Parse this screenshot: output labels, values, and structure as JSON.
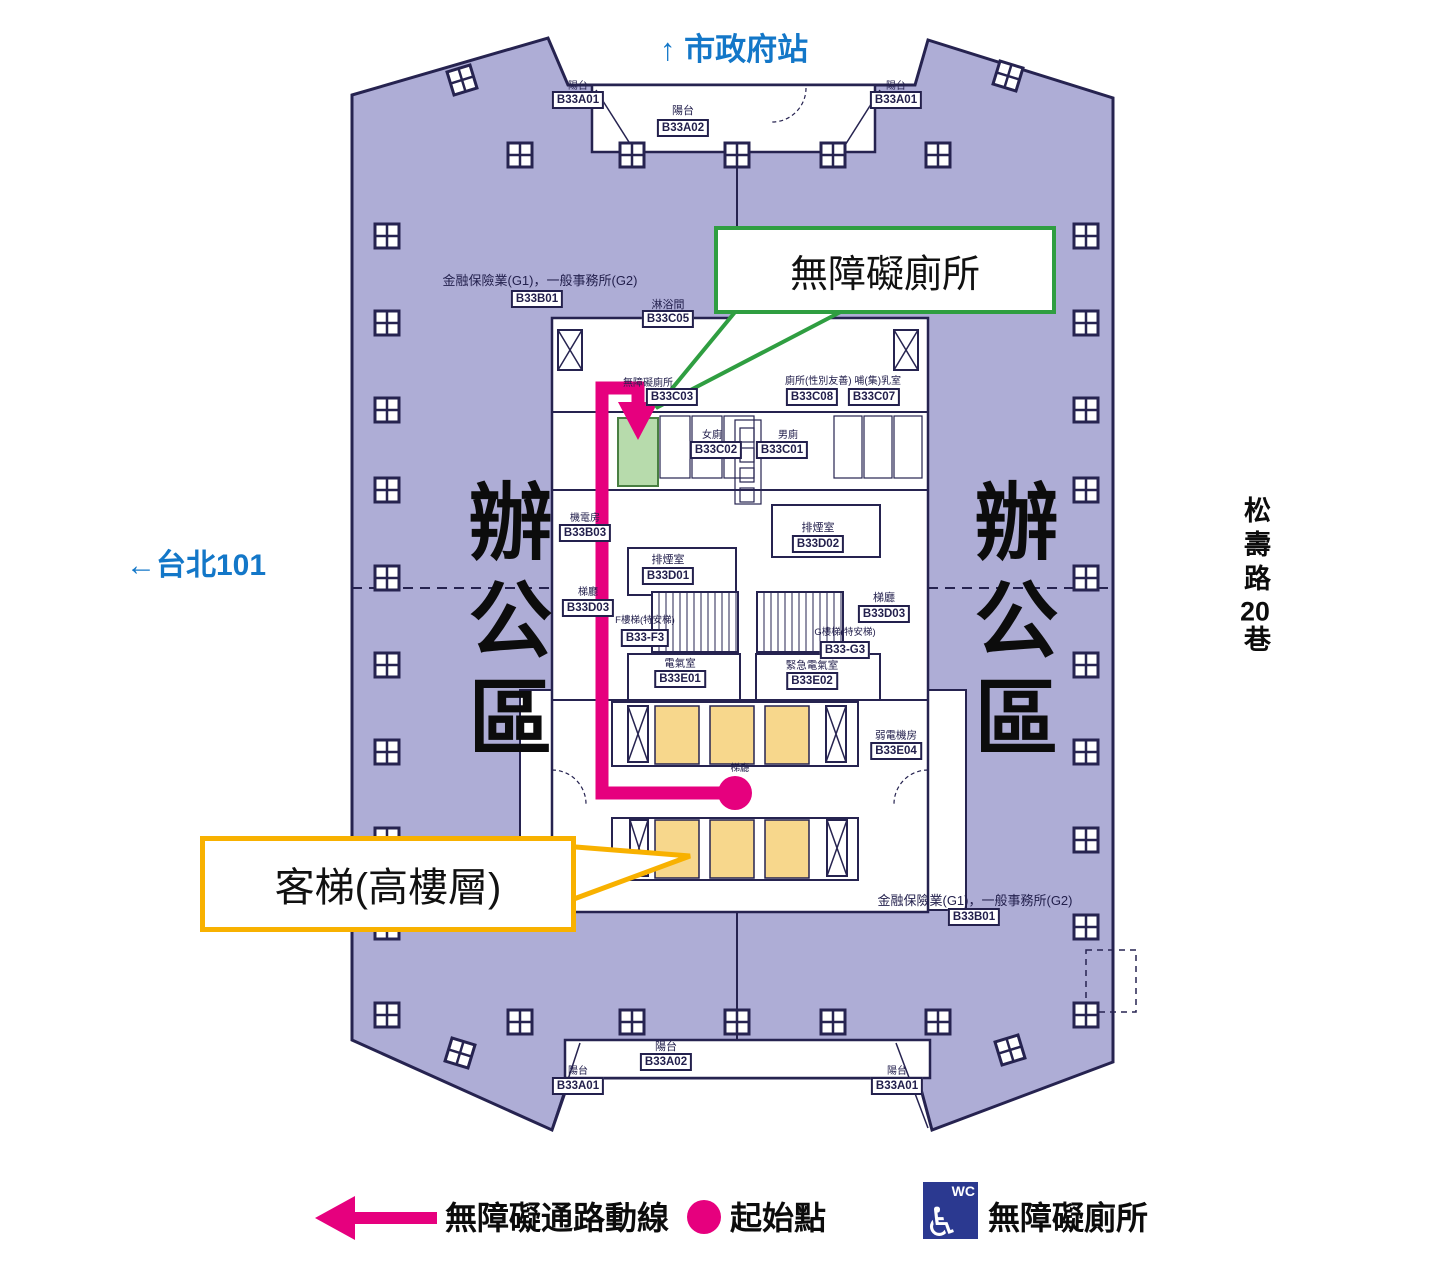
{
  "labels": {
    "top_direction": "↑ 市政府站",
    "left_direction": "←台北101",
    "right_street": "松壽路20巷",
    "office_left": "辦公區",
    "office_right": "辦公區"
  },
  "callouts": {
    "accessible_toilet": "無障礙廁所",
    "passenger_elevator": "客梯(高樓層)"
  },
  "legend": [
    {
      "label": "無障礙通路動線"
    },
    {
      "label": "起始點"
    },
    {
      "label": "無障礙廁所",
      "icon_text": "WC"
    }
  ],
  "colors": {
    "direction_blue": "#1377c8",
    "route_magenta": "#e6007e",
    "callout_green": "#2f9e41",
    "callout_yellow": "#f8b100",
    "office_purple": "#aeadd6",
    "plan_navy": "#262350",
    "wc_blue": "#2b3990",
    "toilet_green_fill": "#b7dbac",
    "elevator_yellow_fill": "#f7d78c"
  },
  "plan": {
    "captions": [
      {
        "t": "陽台",
        "x": 578,
        "y": 87
      },
      {
        "t": "陽台",
        "x": 683,
        "y": 112,
        "s": 11
      },
      {
        "t": "陽台",
        "x": 896,
        "y": 87
      },
      {
        "t": "金融保險業(G1)，一般事務所(G2)",
        "x": 540,
        "y": 281,
        "s": 13
      },
      {
        "t": "淋浴間",
        "x": 668,
        "y": 306,
        "s": 11
      },
      {
        "t": "無障礙廁所",
        "x": 648,
        "y": 384
      },
      {
        "t": "廁所(性別友善) 哺(集)乳室",
        "x": 843,
        "y": 382
      },
      {
        "t": "女廁",
        "x": 712,
        "y": 436
      },
      {
        "t": "男廁",
        "x": 788,
        "y": 436
      },
      {
        "t": "機電房",
        "x": 585,
        "y": 519
      },
      {
        "t": "排煙室",
        "x": 668,
        "y": 561,
        "s": 11
      },
      {
        "t": "排煙室",
        "x": 818,
        "y": 529,
        "s": 11
      },
      {
        "t": "梯廳",
        "x": 588,
        "y": 593
      },
      {
        "t": "梯廳",
        "x": 884,
        "y": 599,
        "s": 11
      },
      {
        "t": "F樓梯(特安梯)",
        "x": 645,
        "y": 621,
        "s": 9.5
      },
      {
        "t": "G樓梯(特安梯)",
        "x": 845,
        "y": 633,
        "s": 9.5
      },
      {
        "t": "電氣室",
        "x": 680,
        "y": 664,
        "s": 10.5
      },
      {
        "t": "緊急電氣室",
        "x": 812,
        "y": 666,
        "s": 10.5
      },
      {
        "t": "梯廳",
        "x": 740,
        "y": 769,
        "s": 9.5
      },
      {
        "t": "弱電機房",
        "x": 896,
        "y": 736,
        "s": 10.5
      },
      {
        "t": "金融保險業(G1)，一般事務所(G2)",
        "x": 975,
        "y": 901,
        "s": 13
      },
      {
        "t": "陽台",
        "x": 578,
        "y": 1072
      },
      {
        "t": "陽台",
        "x": 666,
        "y": 1048,
        "s": 11
      },
      {
        "t": "陽台",
        "x": 897,
        "y": 1072
      }
    ],
    "code_boxes": [
      {
        "t": "B33A01",
        "x": 578,
        "y": 100
      },
      {
        "t": "B33A02",
        "x": 683,
        "y": 128
      },
      {
        "t": "B33A01",
        "x": 896,
        "y": 100
      },
      {
        "t": "B33B01",
        "x": 537,
        "y": 299
      },
      {
        "t": "B33C05",
        "x": 668,
        "y": 319
      },
      {
        "t": "B33C03",
        "x": 672,
        "y": 397
      },
      {
        "t": "B33C08",
        "x": 812,
        "y": 397
      },
      {
        "t": "B33C07",
        "x": 874,
        "y": 397
      },
      {
        "t": "B33C02",
        "x": 716,
        "y": 450
      },
      {
        "t": "B33C01",
        "x": 782,
        "y": 450
      },
      {
        "t": "B33B03",
        "x": 585,
        "y": 533
      },
      {
        "t": "B33D01",
        "x": 668,
        "y": 576
      },
      {
        "t": "B33D02",
        "x": 818,
        "y": 544
      },
      {
        "t": "B33D03",
        "x": 588,
        "y": 608
      },
      {
        "t": "B33D03",
        "x": 884,
        "y": 614
      },
      {
        "t": "B33-F3",
        "x": 645,
        "y": 638
      },
      {
        "t": "B33-G3",
        "x": 845,
        "y": 650
      },
      {
        "t": "B33E01",
        "x": 680,
        "y": 679
      },
      {
        "t": "B33E02",
        "x": 812,
        "y": 681
      },
      {
        "t": "B33E04",
        "x": 896,
        "y": 751
      },
      {
        "t": "B33B01",
        "x": 974,
        "y": 917
      },
      {
        "t": "B33A01",
        "x": 578,
        "y": 1086
      },
      {
        "t": "B33A02",
        "x": 666,
        "y": 1062
      },
      {
        "t": "B33A01",
        "x": 897,
        "y": 1086
      }
    ]
  }
}
